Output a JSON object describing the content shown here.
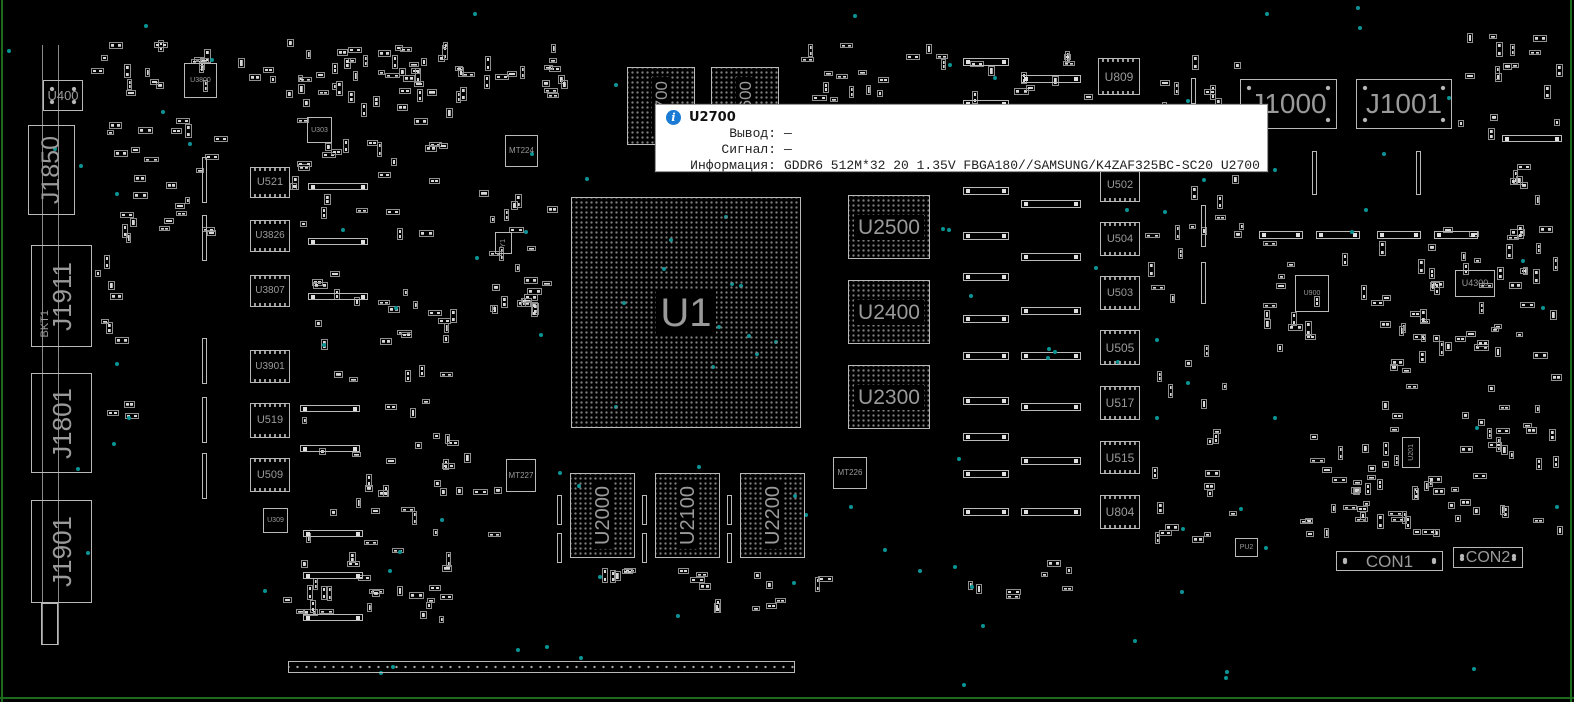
{
  "colors": {
    "board_bg": "#000000",
    "component_outline": "#b9b9b9",
    "silkscreen_text": "#9a9a9a",
    "via_teal": "#0a9494",
    "board_edge_green": "#1c6b1c",
    "tooltip_bg": "#ffffff",
    "tooltip_text": "#222222",
    "info_icon_blue": "#1a7ad4",
    "crosshair_pink": "#cf8f8f"
  },
  "tooltip": {
    "info_icon": "i",
    "title": "U2700",
    "rows": [
      {
        "label": "Вывод:",
        "value": "—"
      },
      {
        "label": "Сигнал:",
        "value": "—"
      },
      {
        "label": "Информация:",
        "value": "GDDR6 512M*32 20 1.35V FBGA180//SAMSUNG/K4ZAF325BC-SC20 U2700"
      }
    ]
  },
  "board": {
    "components": [
      {
        "id": "U1",
        "label": "U1",
        "type": "bga",
        "x": 571,
        "y": 197,
        "w": 230,
        "h": 231,
        "fs": 40
      },
      {
        "id": "U2700",
        "label": "U2700",
        "type": "mem-v",
        "x": 627,
        "y": 67,
        "w": 68,
        "h": 78,
        "fs": 17
      },
      {
        "id": "U2600",
        "label": "U2600",
        "type": "mem-v",
        "x": 711,
        "y": 67,
        "w": 68,
        "h": 78,
        "fs": 17
      },
      {
        "id": "U2500",
        "label": "U2500",
        "type": "mem-h",
        "x": 848,
        "y": 195,
        "w": 82,
        "h": 64,
        "fs": 21
      },
      {
        "id": "U2400",
        "label": "U2400",
        "type": "mem-h",
        "x": 848,
        "y": 280,
        "w": 82,
        "h": 64,
        "fs": 21
      },
      {
        "id": "U2300",
        "label": "U2300",
        "type": "mem-h",
        "x": 848,
        "y": 365,
        "w": 82,
        "h": 64,
        "fs": 21
      },
      {
        "id": "U2000",
        "label": "U2000",
        "type": "mem-v",
        "x": 570,
        "y": 473,
        "w": 65,
        "h": 85,
        "fs": 20
      },
      {
        "id": "U2100",
        "label": "U2100",
        "type": "mem-v",
        "x": 655,
        "y": 473,
        "w": 65,
        "h": 85,
        "fs": 20
      },
      {
        "id": "U2200",
        "label": "U2200",
        "type": "mem-v",
        "x": 740,
        "y": 473,
        "w": 65,
        "h": 85,
        "fs": 20
      },
      {
        "id": "U400",
        "label": "U400",
        "type": "conn",
        "x": 43,
        "y": 80,
        "w": 40,
        "h": 31,
        "fs": 13
      },
      {
        "id": "J1850",
        "label": "J1850",
        "type": "connv",
        "x": 28,
        "y": 125,
        "w": 47,
        "h": 90,
        "fs": 25
      },
      {
        "id": "J1911",
        "label": "J1911",
        "type": "connv",
        "x": 31,
        "y": 245,
        "w": 61,
        "h": 102,
        "fs": 26
      },
      {
        "id": "BKT1",
        "label": "BKT1",
        "type": "textv",
        "x": 38,
        "y": 300,
        "w": 14,
        "h": 48,
        "fs": 11
      },
      {
        "id": "J1801",
        "label": "J1801",
        "type": "connv",
        "x": 31,
        "y": 373,
        "w": 61,
        "h": 100,
        "fs": 26
      },
      {
        "id": "J1901",
        "label": "J1901",
        "type": "connv",
        "x": 31,
        "y": 500,
        "w": 61,
        "h": 103,
        "fs": 26
      },
      {
        "id": "U3800",
        "label": "U3800",
        "type": "small",
        "x": 184,
        "y": 63,
        "w": 33,
        "h": 35,
        "fs": 7
      },
      {
        "id": "U303",
        "label": "U303",
        "type": "small",
        "x": 307,
        "y": 117,
        "w": 25,
        "h": 26,
        "fs": 7
      },
      {
        "id": "U521",
        "label": "U521",
        "type": "qfp",
        "x": 250,
        "y": 167,
        "w": 40,
        "h": 31,
        "fs": 11
      },
      {
        "id": "U3826",
        "label": "U3826",
        "type": "qfp",
        "x": 250,
        "y": 220,
        "w": 40,
        "h": 32,
        "fs": 10
      },
      {
        "id": "U3807",
        "label": "U3807",
        "type": "qfp",
        "x": 250,
        "y": 275,
        "w": 40,
        "h": 32,
        "fs": 10
      },
      {
        "id": "U3901",
        "label": "U3901",
        "type": "qfp",
        "x": 250,
        "y": 350,
        "w": 40,
        "h": 33,
        "fs": 10
      },
      {
        "id": "U519",
        "label": "U519",
        "type": "qfp",
        "x": 250,
        "y": 403,
        "w": 40,
        "h": 35,
        "fs": 11
      },
      {
        "id": "U509",
        "label": "U509",
        "type": "qfp",
        "x": 250,
        "y": 458,
        "w": 40,
        "h": 34,
        "fs": 11
      },
      {
        "id": "U309",
        "label": "U309",
        "type": "small",
        "x": 263,
        "y": 508,
        "w": 25,
        "h": 25,
        "fs": 7
      },
      {
        "id": "MT224",
        "label": "MT224",
        "type": "small",
        "x": 505,
        "y": 135,
        "w": 33,
        "h": 32,
        "fs": 8
      },
      {
        "id": "Y1",
        "label": "Y1",
        "type": "smallv",
        "x": 495,
        "y": 232,
        "w": 17,
        "h": 22,
        "fs": 7
      },
      {
        "id": "MT227",
        "label": "MT227",
        "type": "small",
        "x": 506,
        "y": 459,
        "w": 30,
        "h": 33,
        "fs": 8
      },
      {
        "id": "MT226",
        "label": "MT226",
        "type": "small",
        "x": 833,
        "y": 457,
        "w": 34,
        "h": 32,
        "fs": 8
      },
      {
        "id": "U809",
        "label": "U809",
        "type": "qfp",
        "x": 1098,
        "y": 58,
        "w": 42,
        "h": 37,
        "fs": 12
      },
      {
        "id": "U502",
        "label": "U502",
        "type": "qfp",
        "x": 1100,
        "y": 168,
        "w": 40,
        "h": 34,
        "fs": 11
      },
      {
        "id": "U504",
        "label": "U504",
        "type": "qfp",
        "x": 1100,
        "y": 222,
        "w": 40,
        "h": 34,
        "fs": 11
      },
      {
        "id": "U503",
        "label": "U503",
        "type": "qfp",
        "x": 1100,
        "y": 276,
        "w": 40,
        "h": 34,
        "fs": 11
      },
      {
        "id": "U505",
        "label": "U505",
        "type": "qfp",
        "x": 1100,
        "y": 330,
        "w": 40,
        "h": 35,
        "fs": 12
      },
      {
        "id": "U517",
        "label": "U517",
        "type": "qfp",
        "x": 1100,
        "y": 386,
        "w": 40,
        "h": 34,
        "fs": 12
      },
      {
        "id": "U515",
        "label": "U515",
        "type": "qfp",
        "x": 1100,
        "y": 441,
        "w": 40,
        "h": 33,
        "fs": 12
      },
      {
        "id": "U804",
        "label": "U804",
        "type": "qfp",
        "x": 1100,
        "y": 495,
        "w": 40,
        "h": 34,
        "fs": 12
      },
      {
        "id": "J1000",
        "label": "J1000",
        "type": "conn",
        "x": 1240,
        "y": 79,
        "w": 97,
        "h": 50,
        "fs": 28
      },
      {
        "id": "J1001",
        "label": "J1001",
        "type": "conn",
        "x": 1356,
        "y": 79,
        "w": 96,
        "h": 50,
        "fs": 28
      },
      {
        "id": "U900",
        "label": "U900",
        "type": "small",
        "x": 1295,
        "y": 275,
        "w": 34,
        "h": 37,
        "fs": 7
      },
      {
        "id": "U4300",
        "label": "U4300",
        "type": "small",
        "x": 1455,
        "y": 270,
        "w": 40,
        "h": 27,
        "fs": 9
      },
      {
        "id": "U201",
        "label": "U201",
        "type": "smallv",
        "x": 1402,
        "y": 437,
        "w": 18,
        "h": 31,
        "fs": 7
      },
      {
        "id": "PU2",
        "label": "PU2",
        "type": "small",
        "x": 1235,
        "y": 538,
        "w": 23,
        "h": 19,
        "fs": 7
      },
      {
        "id": "CON1",
        "label": "CON1",
        "type": "conn",
        "x": 1336,
        "y": 551,
        "w": 107,
        "h": 20,
        "fs": 17
      },
      {
        "id": "CON2",
        "label": "CON2",
        "type": "conn",
        "x": 1453,
        "y": 547,
        "w": 70,
        "h": 21,
        "fs": 16
      }
    ]
  }
}
